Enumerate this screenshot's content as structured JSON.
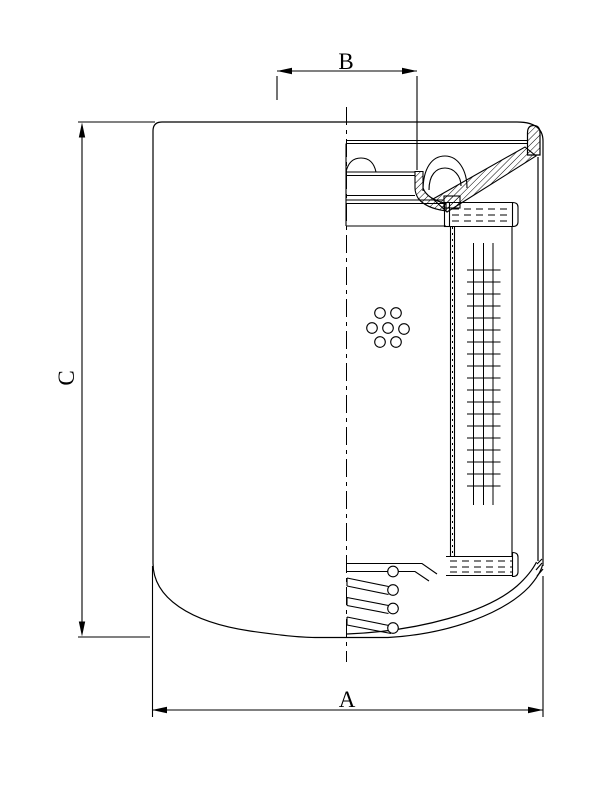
{
  "drawing": {
    "background_color": "#ffffff",
    "line_color": "#000000",
    "dimensions": {
      "bottom_width_label": "A",
      "top_width_label": "B",
      "left_height_label": "C"
    }
  }
}
